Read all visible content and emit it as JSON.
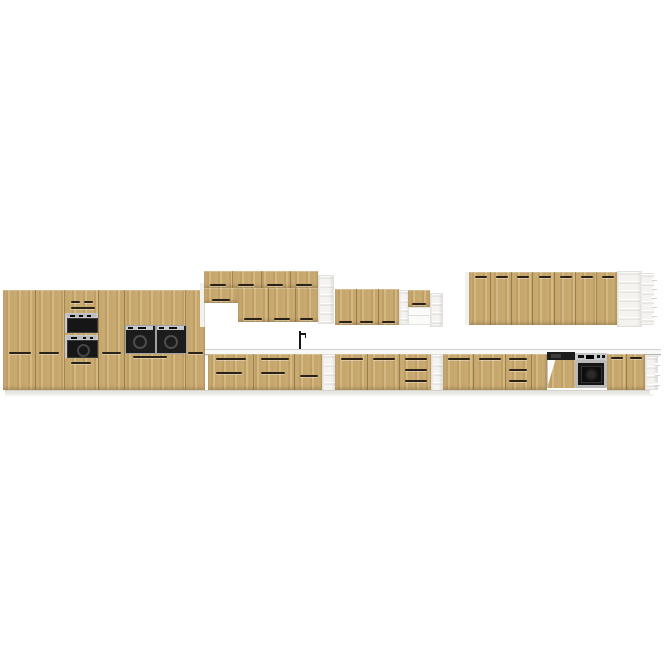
{
  "image": {
    "type": "product-render",
    "subject": "modular kitchen furniture line in light oak finish on white background"
  },
  "colors": {
    "background": "#ffffff",
    "wood_a": "#c9ab72",
    "wood_b": "#c09f66",
    "wood_c": "#d4b881",
    "wood_d": "#c6a76e",
    "gap_line": "#604c26",
    "handle": "#2b2217",
    "white_unit": "#f4f3f0",
    "shelf_shadow": "#d8d7d2",
    "counter_top": "#f8f8f6",
    "counter_edge": "#b7b6b1",
    "plinth": "#e8e6e1",
    "frame_silver": "#c7c9ca",
    "glass_black": "#161616",
    "appliance_dark": "#1c1c1c"
  },
  "sections": [
    {
      "id": "tall-cabinet-run",
      "units": [
        "tall 2-door cabinet",
        "tall 2-door cabinet",
        "tall oven housing with microwave and oven",
        "tall 2-door cabinet",
        "double built-in compact appliance unit",
        "tall drawer cabinet"
      ]
    },
    {
      "id": "wall-cabinet-group-left",
      "units": [
        "top box row with 4 doors",
        "short wall cabinet",
        "wall cabinets with 3 doors",
        "open shelf column"
      ]
    },
    {
      "id": "wall-cabinet-group-middle",
      "units": [
        "wall cabinets with 3 doors",
        "open shelf column",
        "small wall cabinet with open compartment below",
        "open shelf column"
      ]
    },
    {
      "id": "wall-cabinet-run-right",
      "units": [
        "wall cabinet run with 7 doors",
        "open shelf unit",
        "open shelf unit"
      ]
    },
    {
      "id": "base-cabinet-run",
      "units": [
        "drawer base cabinets",
        "open shelf column",
        "base cabinets with drawer stack",
        "open shelf column",
        "base cabinets with drawer stack",
        "semi-integrated dishwasher with open wood front",
        "built-in oven",
        "2-door base cabinet",
        "open end shelf"
      ],
      "extras": [
        "countertop",
        "faucet",
        "plinth"
      ]
    }
  ]
}
